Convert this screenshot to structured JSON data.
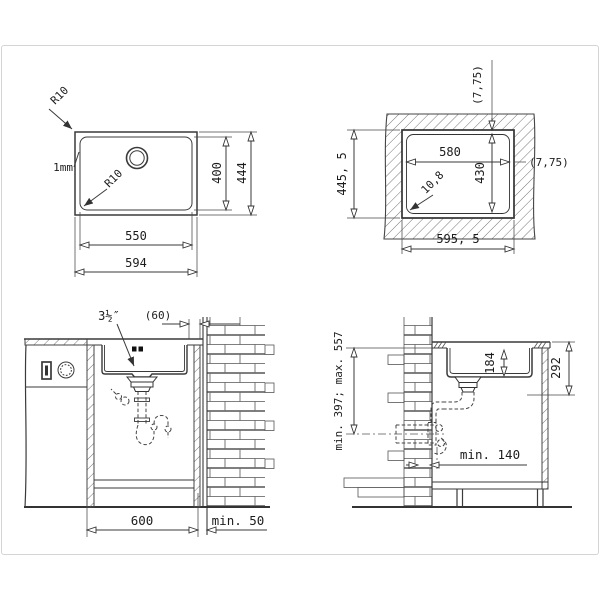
{
  "plan": {
    "r10_top": "R10",
    "thickness": "1mm",
    "r10_inner": "R10",
    "inner_width": "550",
    "outer_width": "594",
    "inner_height": "400",
    "outer_height": "444"
  },
  "cutout": {
    "offset_top": "(7,75)",
    "offset_right": "(7,75)",
    "width": "580",
    "height": "430",
    "radius": "10,8",
    "overall_height": "445, 5",
    "overall_width": "595, 5"
  },
  "front": {
    "drain": "3½″",
    "rear_gap": "(60)",
    "width": "600",
    "wall_gap": "min. 50"
  },
  "side": {
    "depth": "184",
    "height_below_top": "292",
    "outlet_range": "min. 397; max. 557",
    "wall_distance": "min. 140"
  }
}
